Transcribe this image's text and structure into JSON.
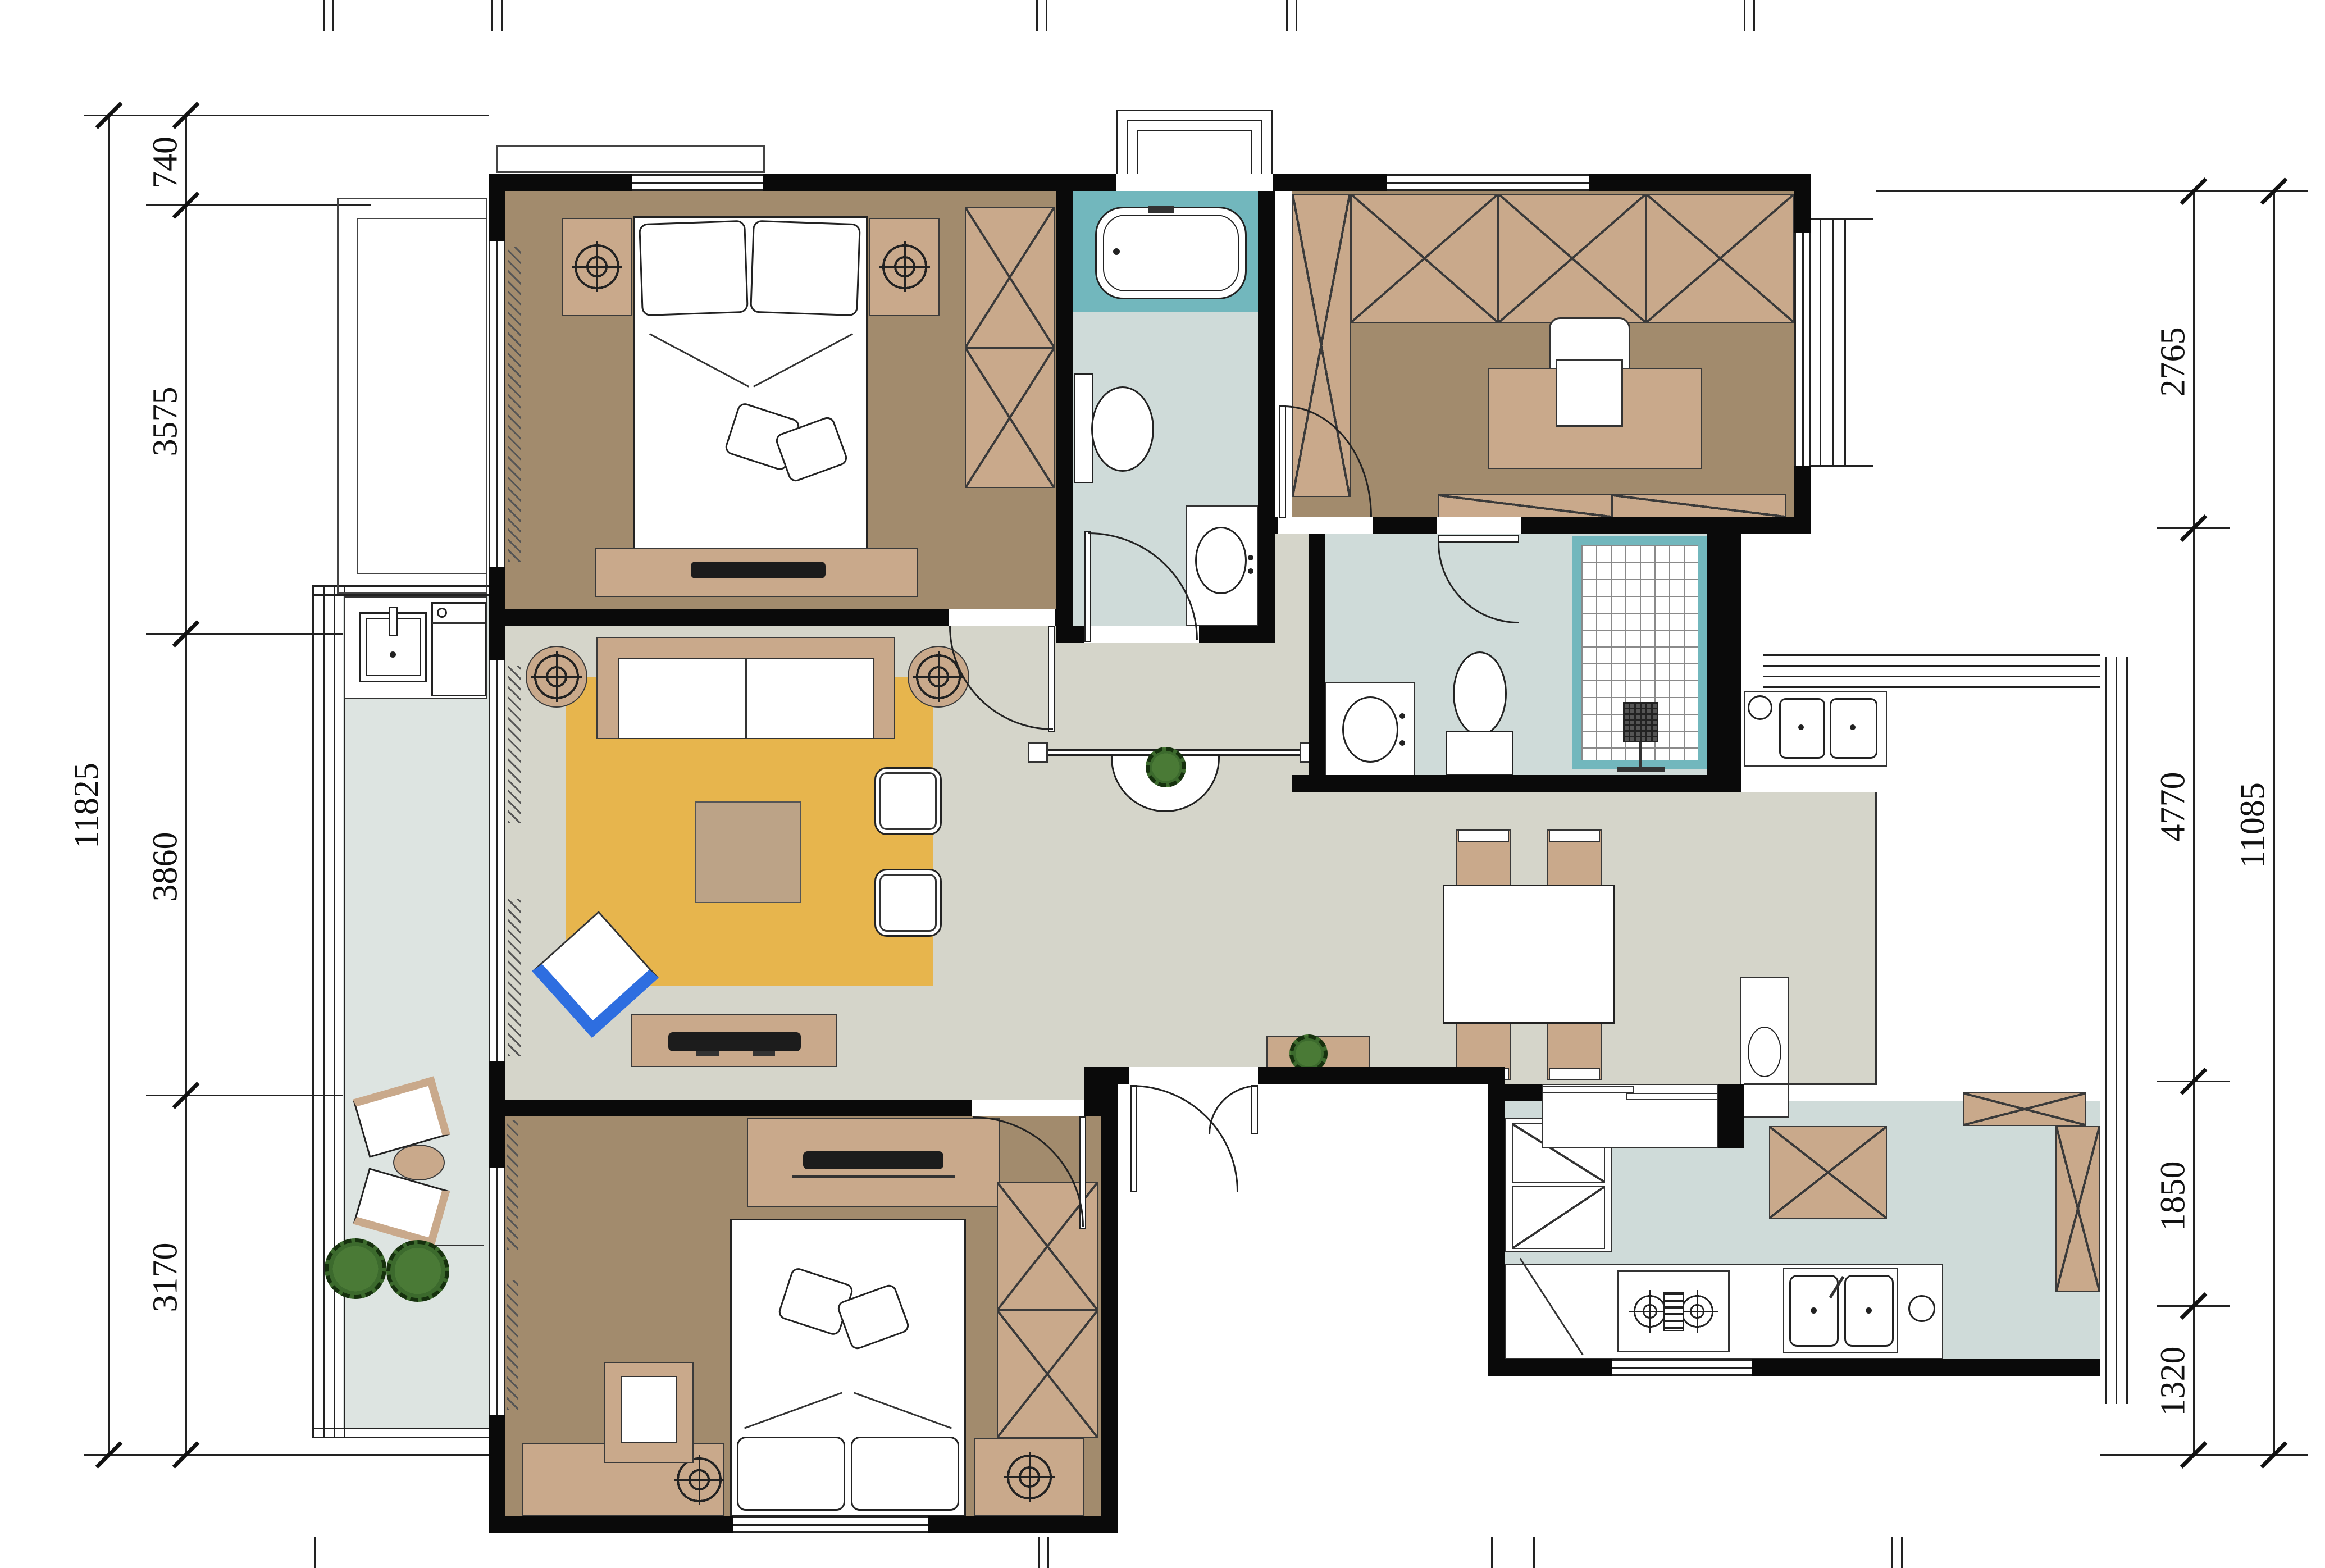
{
  "drawing": {
    "type": "residential-floor-plan"
  },
  "dimensions": {
    "left": {
      "overall": "11825",
      "segments": [
        {
          "label": "740"
        },
        {
          "label": "3575"
        },
        {
          "label": "3860"
        },
        {
          "label": "3170"
        }
      ]
    },
    "right": {
      "overall": "11085",
      "segments": [
        {
          "label": "2765"
        },
        {
          "label": "4770"
        },
        {
          "label": "1850"
        },
        {
          "label": "1320"
        }
      ]
    }
  },
  "colors": {
    "wall": "#0a0a0a",
    "floor-bed": "#a28b6d",
    "floor-hall": "#d5d5ca",
    "floor-bath": "#cfdbd9",
    "floor-balc": "#dde4e1",
    "teal": "#72b7bd",
    "tan": "#c9a98b",
    "rug": "#e7b54d",
    "coffee": "#bca387",
    "plant": "#3c6a2d",
    "blue": "#2e6ee0"
  }
}
